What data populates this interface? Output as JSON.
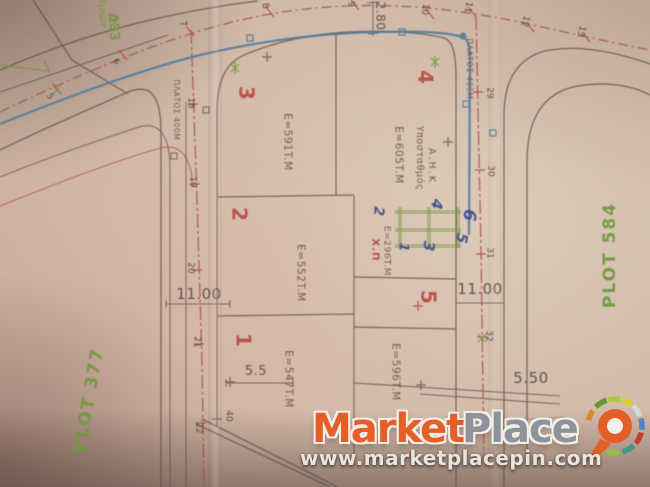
{
  "plan": {
    "region_labels": {
      "plot_left": "PLOT 377",
      "plot_right": "PLOT 584",
      "block": "Δ33",
      "section": "Τμημα"
    },
    "plots": [
      {
        "number": "1",
        "area": "E=547T.M"
      },
      {
        "number": "2",
        "area": "E=552T.M"
      },
      {
        "number": "3",
        "area": "E=591T.M"
      },
      {
        "number": "4",
        "area": "E=605T.M"
      },
      {
        "number": "5",
        "area": "E=596T.M"
      }
    ],
    "small_parcel": {
      "label": "Χ.Π",
      "area": "E=296T.M"
    },
    "substation": {
      "line1": "Υποσταθμός",
      "line2": "Α.Η.Κ"
    },
    "road_width_left": "ΠΛΑΤΟΣ 400Μ",
    "road_width_right": "ΠΛΑΤΟΣ 400Μ",
    "dimensions": {
      "offset_top": "2.80",
      "road_left_width": "11.00",
      "road_right_width": "11.00",
      "half_width_left": "5.5",
      "half_width_right": "5.50"
    },
    "stations": {
      "top": [
        "5",
        "6",
        "7",
        "8",
        "9",
        "10",
        "11",
        "12",
        "13"
      ],
      "left": [
        "18",
        "19",
        "20",
        "21",
        "22"
      ],
      "left_extra": "40",
      "right": [
        "29",
        "30",
        "31",
        "32"
      ]
    },
    "handwritten_numbers": [
      "1",
      "2",
      "3",
      "4",
      "5",
      "6"
    ]
  },
  "watermark": {
    "brand_primary": "Market",
    "brand_secondary": "Place",
    "website": "www.marketplacepin.com"
  },
  "colors": {
    "plan_line": "#5f4e45",
    "road_centerline": "#b0453e",
    "stream_blue": "#4a7c9e",
    "annotation_green": "#74973c",
    "plot_number_red": "#bf4840",
    "handwriting_blue": "#3d4f93",
    "brand_orange": "#e45f28",
    "brand_gray": "#8d939b"
  }
}
